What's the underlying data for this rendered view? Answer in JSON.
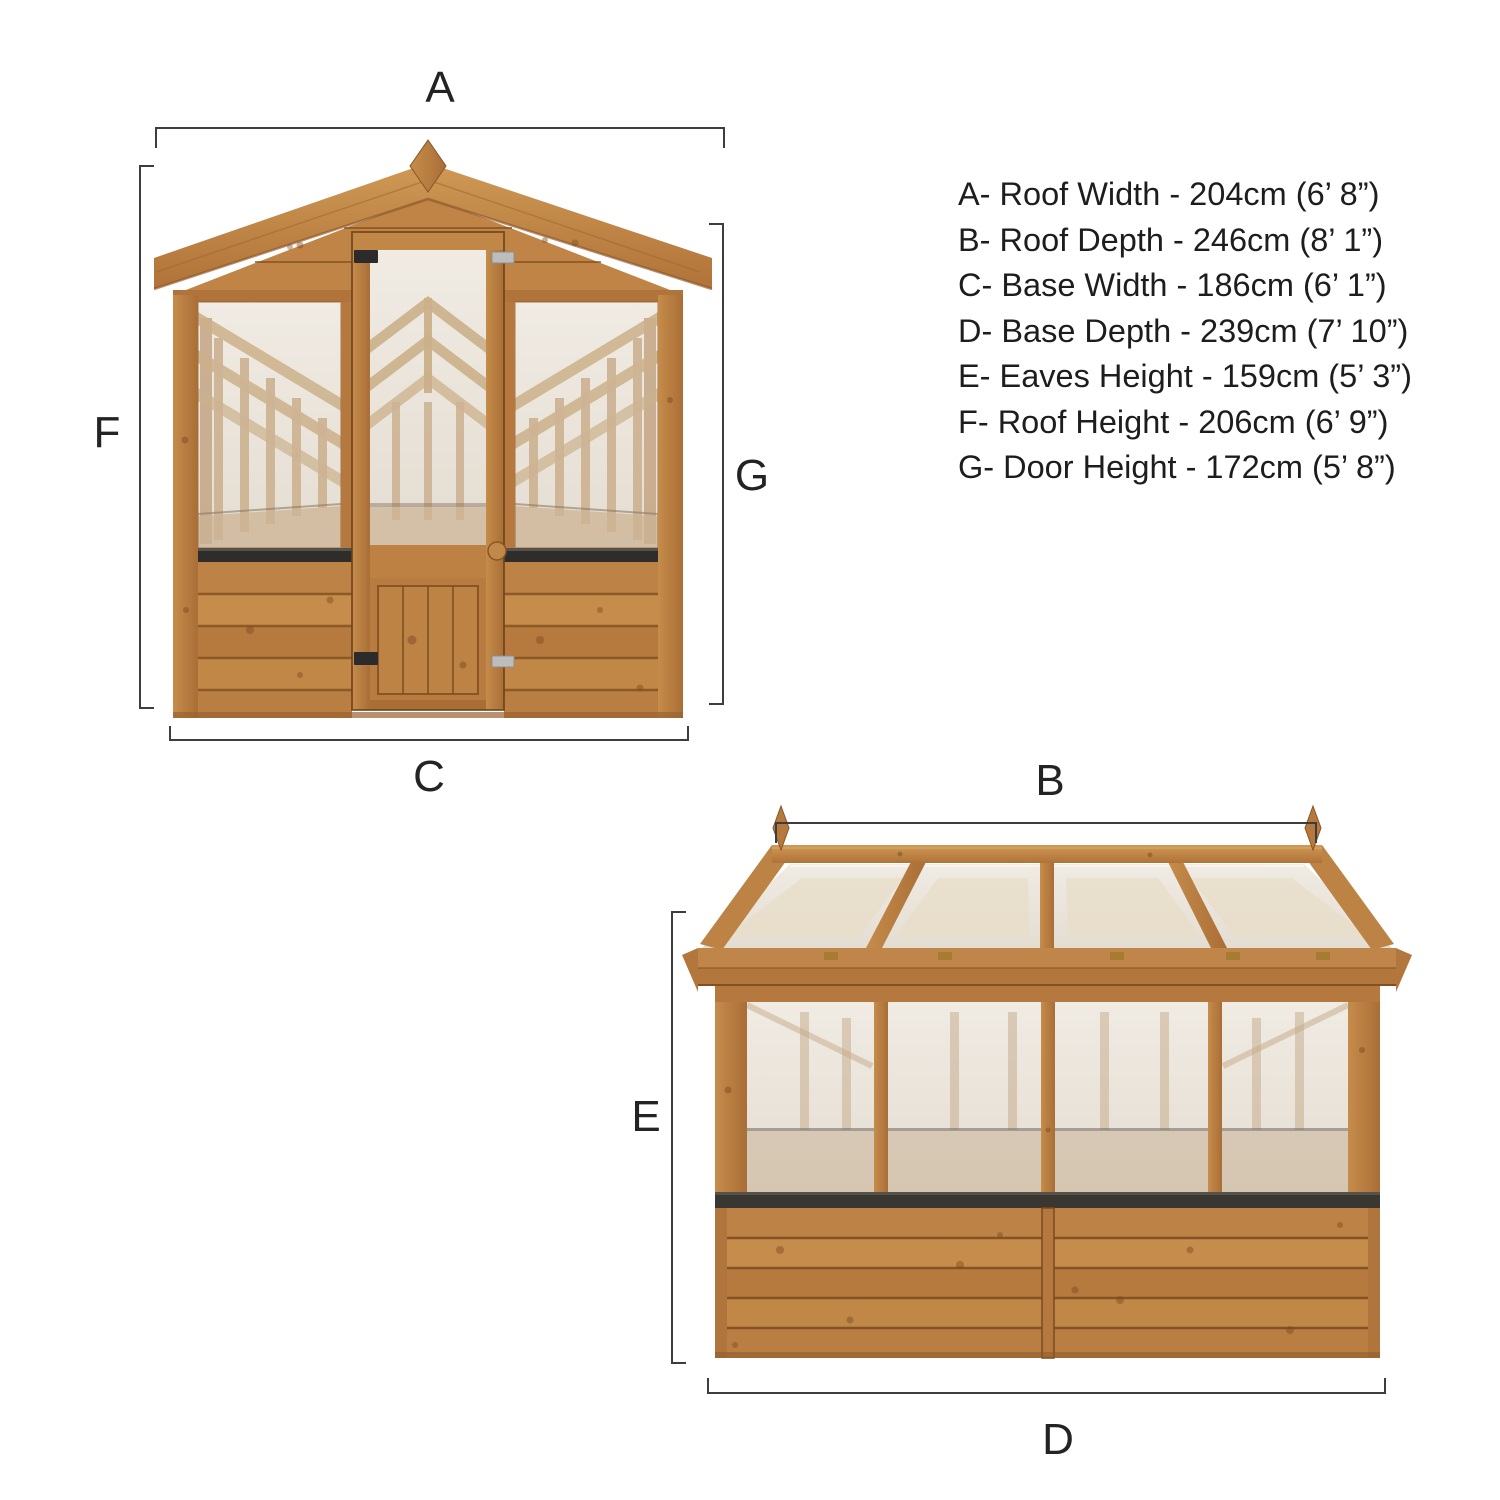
{
  "diagram_title": "Greenhouse dimension diagram",
  "dimension_labels": {
    "roof_width": "A",
    "roof_depth": "B",
    "base_width": "C",
    "base_depth": "D",
    "eaves_height": "E",
    "roof_height": "F",
    "door_height": "G"
  },
  "legend": {
    "items": [
      "A- Roof Width - 204cm (6’ 8”)",
      "B- Roof Depth - 246cm (8’ 1”)",
      "C- Base Width - 186cm (6’ 1”)",
      "D- Base Depth - 239cm (7’ 10”)",
      "E- Eaves Height - 159cm (5’ 3”)",
      "F- Roof Height - 206cm (6’ 9”)",
      "G- Door Height - 172cm (5’ 8”)"
    ]
  },
  "colors": {
    "wood": "#b87c41",
    "wood_dark": "#7d4a20",
    "glass": "#e9e3da",
    "sill": "#33302b",
    "dimension_line": "#3d3d3d",
    "text": "#1d1d1d",
    "background": "#ffffff"
  }
}
